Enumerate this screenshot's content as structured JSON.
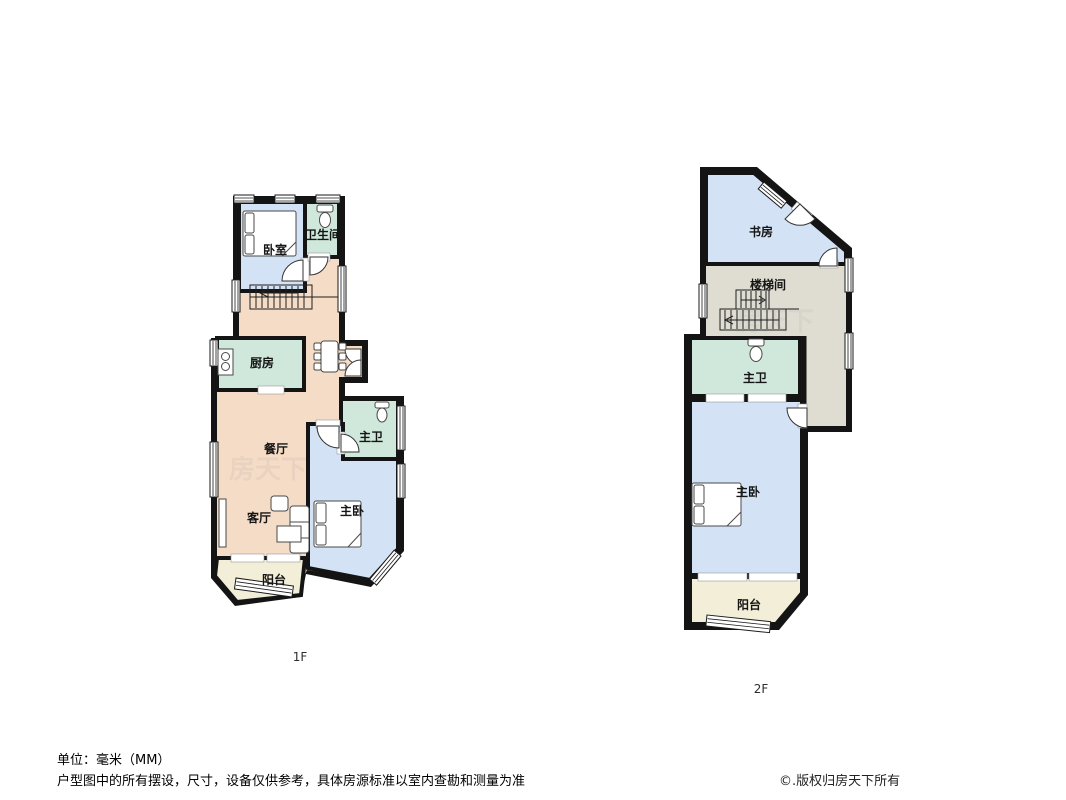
{
  "colors": {
    "wall": "#141414",
    "room_blue": "#d3e2f4",
    "room_green": "#cfe8db",
    "room_beige": "#f4dcc6",
    "room_cream": "#f2eed8",
    "room_grey": "#dfddd2",
    "background": "#ffffff"
  },
  "floors": [
    {
      "label": "1F",
      "rooms": [
        {
          "name": "bedroom",
          "label": "卧室"
        },
        {
          "name": "bathroom",
          "label": "卫生间"
        },
        {
          "name": "kitchen",
          "label": "厨房"
        },
        {
          "name": "dining-room",
          "label": "餐厅"
        },
        {
          "name": "master-bathroom",
          "label": "主卫"
        },
        {
          "name": "living-room",
          "label": "客厅"
        },
        {
          "name": "master-bedroom",
          "label": "主卧"
        },
        {
          "name": "balcony",
          "label": "阳台"
        }
      ]
    },
    {
      "label": "2F",
      "rooms": [
        {
          "name": "study",
          "label": "书房"
        },
        {
          "name": "stairwell",
          "label": "楼梯间"
        },
        {
          "name": "master-bathroom",
          "label": "主卫"
        },
        {
          "name": "master-bedroom",
          "label": "主卧"
        },
        {
          "name": "balcony",
          "label": "阳台"
        }
      ]
    }
  ],
  "footer": {
    "unit_note": "单位：毫米（MM）",
    "disclaimer": "户型图中的所有摆设，尺寸，设备仅供参考，具体房源标准以室内查勘和测量为准",
    "copyright": "©.版权归房天下所有"
  },
  "watermark": "房天下"
}
